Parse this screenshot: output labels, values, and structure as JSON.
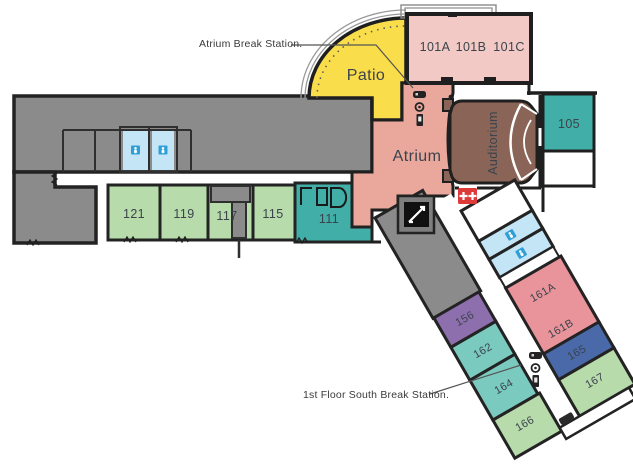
{
  "plan": {
    "title": "First floor building plan",
    "annotations": {
      "atrium_break_station": "Atrium Break Station.",
      "south_break_station": "1st Floor South Break Station."
    },
    "areas": {
      "patio": "Patio",
      "atrium": "Atrium",
      "auditorium": "Auditorium"
    },
    "rooms": {
      "r101a": "101A",
      "r101b": "101B",
      "r101c": "101C",
      "r105": "105",
      "r111": "111",
      "r115": "115",
      "r117": "117",
      "r119": "119",
      "r121": "121",
      "r156": "156",
      "r161a": "161A",
      "r161b": "161B",
      "r162": "162",
      "r164": "164",
      "r165": "165",
      "r166": "166",
      "r167": "167"
    },
    "icons": {
      "restroom": "person-on-blue-square",
      "stairs": "white-diagonal-on-black-square",
      "first_aid": "two-white-crosses-on-red-square",
      "break_station": "vending-machine-table-and-kiosk-cluster",
      "bench": "dark-rounded-bar",
      "door": "black-door-nub"
    },
    "colors": {
      "wall": "#1f1f1f",
      "gray_area": "#8b8b8b",
      "stair_gray": "#7e7e7e",
      "patio_yellow": "#fadd4b",
      "classroom_pink": "#f2c9c4",
      "atrium_salmon": "#e9a89b",
      "auditorium_brown": "#8a6557",
      "teal_dark": "#41aea8",
      "teal_light": "#7bcac0",
      "green": "#b7dbab",
      "purple": "#8e6fae",
      "rose": "#e9939a",
      "indigo": "#4a69a8",
      "restroom_blue": "#c4e5f6",
      "icon_blue": "#2f9fd8",
      "first_aid_red": "#dd3a39"
    }
  }
}
